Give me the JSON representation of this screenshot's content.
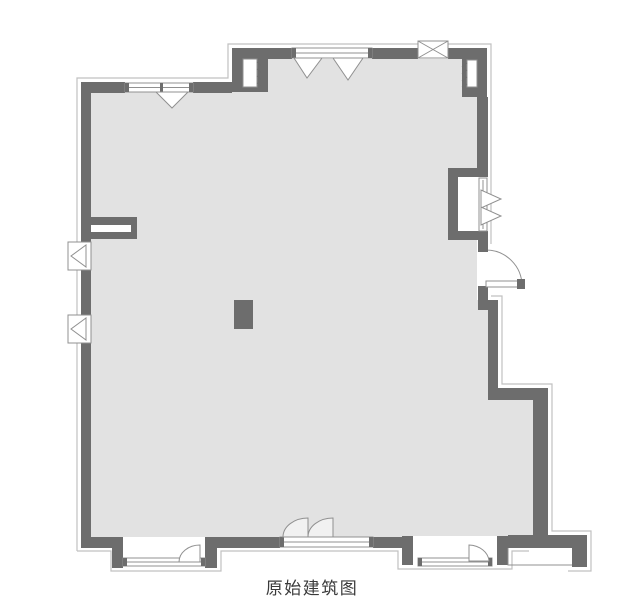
{
  "caption": "原始建筑图",
  "colors": {
    "background": "#ffffff",
    "floor": "#e2e2e2",
    "wall": "#6d6d6d",
    "outline": "#c0c0c0",
    "glass": "#ffffff",
    "sym": "#909090",
    "fin": "#f1f1f1",
    "text": "#3a3a3a"
  },
  "plan": {
    "shapes": [
      {
        "t": "path",
        "n": "outer-outline-left-top",
        "d": "M77,551 L77,78 L228,78 L228,44 L491,44 L491,244",
        "k": "outline",
        "sw": 1.2
      },
      {
        "t": "path",
        "n": "outer-outline-right",
        "d": "M491,296 L502,296 L502,384 L552,384 L552,531 L591,531 L591,571 L568,571",
        "k": "outline",
        "sw": 1.2
      },
      {
        "t": "path",
        "n": "outer-outline-bottom",
        "d": "M77,551 L111,551 L111,571 L221,571 L221,551 L398,551 L398,569 L512,569 L512,551 L529,551",
        "k": "outline",
        "sw": 1.2
      },
      {
        "t": "poly",
        "n": "floor",
        "p": "91,92 268,92 268,59 462,59 462,97 477,97 477,168 448,168 448,240 477,240 477,300 488,300 488,400 533,400 533,537 91,537",
        "f": "floor"
      },
      {
        "t": "rect",
        "n": "bay1-sill",
        "x": 125,
        "y": 537,
        "w": 82,
        "h": 22,
        "f": "glass"
      },
      {
        "t": "rect",
        "n": "bay2-sill",
        "x": 413,
        "y": 536,
        "w": 84,
        "h": 22,
        "f": "glass"
      },
      {
        "t": "rect",
        "n": "wall-left-upper",
        "x": 81,
        "y": 82,
        "w": 10,
        "h": 160,
        "f": "wall"
      },
      {
        "t": "rect",
        "n": "wall-left-mid",
        "x": 81,
        "y": 270,
        "w": 10,
        "h": 45,
        "f": "wall"
      },
      {
        "t": "rect",
        "n": "wall-left-lower",
        "x": 81,
        "y": 343,
        "w": 10,
        "h": 204,
        "f": "wall"
      },
      {
        "t": "rect",
        "n": "wall-top-left-a",
        "x": 81,
        "y": 82,
        "w": 44,
        "h": 11,
        "f": "wall"
      },
      {
        "t": "rect",
        "n": "wall-top-left-b",
        "x": 193,
        "y": 82,
        "w": 39,
        "h": 11,
        "f": "wall"
      },
      {
        "t": "rect",
        "n": "shaft-top-left-body",
        "x": 232,
        "y": 48,
        "w": 36,
        "h": 44,
        "f": "wall"
      },
      {
        "t": "rect",
        "n": "wall-top-upper-a",
        "x": 268,
        "y": 48,
        "w": 24,
        "h": 11,
        "f": "wall"
      },
      {
        "t": "rect",
        "n": "wall-top-upper-b",
        "x": 372,
        "y": 48,
        "w": 46,
        "h": 11,
        "f": "wall"
      },
      {
        "t": "rect",
        "n": "wall-top-upper-c",
        "x": 448,
        "y": 48,
        "w": 39,
        "h": 11,
        "f": "wall"
      },
      {
        "t": "rect",
        "n": "shaft-top-right-body",
        "x": 462,
        "y": 48,
        "w": 25,
        "h": 49,
        "f": "wall"
      },
      {
        "t": "rect",
        "n": "wall-right-upper",
        "x": 477,
        "y": 97,
        "w": 11,
        "h": 71,
        "f": "wall"
      },
      {
        "t": "rect",
        "n": "niche-wall-top",
        "x": 448,
        "y": 168,
        "w": 40,
        "h": 9,
        "f": "wall"
      },
      {
        "t": "rect",
        "n": "niche-wall-left",
        "x": 448,
        "y": 168,
        "w": 10,
        "h": 72,
        "f": "wall"
      },
      {
        "t": "rect",
        "n": "niche-wall-bottom",
        "x": 448,
        "y": 231,
        "w": 40,
        "h": 9,
        "f": "wall"
      },
      {
        "t": "rect",
        "n": "door-jamb-top",
        "x": 478,
        "y": 240,
        "w": 10,
        "h": 12,
        "f": "wall"
      },
      {
        "t": "rect",
        "n": "door-jamb-bottom",
        "x": 478,
        "y": 286,
        "w": 10,
        "h": 24,
        "f": "wall"
      },
      {
        "t": "rect",
        "n": "wall-jog",
        "x": 478,
        "y": 300,
        "w": 20,
        "h": 10,
        "f": "wall"
      },
      {
        "t": "rect",
        "n": "wall-right-mid",
        "x": 488,
        "y": 300,
        "w": 10,
        "h": 100,
        "f": "wall"
      },
      {
        "t": "rect",
        "n": "wall-step-bar",
        "x": 488,
        "y": 388,
        "w": 60,
        "h": 12,
        "f": "wall"
      },
      {
        "t": "rect",
        "n": "wall-right-lower",
        "x": 533,
        "y": 400,
        "w": 15,
        "h": 137,
        "f": "wall"
      },
      {
        "t": "rect",
        "n": "wall-bottom-right",
        "x": 508,
        "y": 535,
        "w": 79,
        "h": 13,
        "f": "wall"
      },
      {
        "t": "rect",
        "n": "porch-stub",
        "x": 572,
        "y": 535,
        "w": 15,
        "h": 32,
        "f": "wall"
      },
      {
        "t": "rect",
        "n": "bay2-stub-left",
        "x": 402,
        "y": 536,
        "w": 11,
        "h": 29,
        "f": "wall"
      },
      {
        "t": "rect",
        "n": "bay2-stub-right",
        "x": 497,
        "y": 536,
        "w": 11,
        "h": 29,
        "f": "wall"
      },
      {
        "t": "rect",
        "n": "wall-bottom-mid-right",
        "x": 373,
        "y": 537,
        "w": 29,
        "h": 11,
        "f": "wall"
      },
      {
        "t": "rect",
        "n": "wall-bottom-mid-left",
        "x": 217,
        "y": 537,
        "w": 63,
        "h": 11,
        "f": "wall"
      },
      {
        "t": "rect",
        "n": "bay1-stub-left",
        "x": 112,
        "y": 537,
        "w": 11,
        "h": 31,
        "f": "wall"
      },
      {
        "t": "rect",
        "n": "bay1-stub-right",
        "x": 205,
        "y": 537,
        "w": 12,
        "h": 31,
        "f": "wall"
      },
      {
        "t": "rect",
        "n": "wall-bottom-left",
        "x": 81,
        "y": 537,
        "w": 34,
        "h": 11,
        "f": "wall"
      },
      {
        "t": "rect",
        "n": "shaft-top-left-inset",
        "x": 243,
        "y": 59,
        "w": 14,
        "h": 28,
        "f": "glass",
        "k": "sym"
      },
      {
        "t": "path",
        "n": "shaft-top-left-hatch",
        "d": "M257,62 l5,4 M257,69 l5,4 M257,76 l5,4 M257,83 l5,3",
        "k": "wall"
      },
      {
        "t": "rect",
        "n": "shaft-top-right-inset",
        "x": 467,
        "y": 60,
        "w": 10,
        "h": 27,
        "f": "glass",
        "k": "sym"
      },
      {
        "t": "path",
        "n": "shaft-top-right-hatch",
        "d": "M467,63 l-5,4 M467,70 l-5,4 M467,77 l-5,4 M467,84 l-5,3",
        "k": "wall"
      },
      {
        "t": "rect",
        "n": "partition-stub-body",
        "x": 91,
        "y": 217,
        "w": 46,
        "h": 22,
        "f": "wall"
      },
      {
        "t": "rect",
        "n": "partition-stub-core",
        "x": 91,
        "y": 225,
        "w": 40,
        "h": 7,
        "f": "glass"
      },
      {
        "t": "rect",
        "n": "window-top-left",
        "x": 125,
        "y": 83,
        "w": 68,
        "h": 9,
        "f": "glass",
        "k": "sym"
      },
      {
        "t": "path",
        "n": "window-top-left-line",
        "d": "M125,87.5 H193",
        "k": "sym"
      },
      {
        "t": "rect",
        "n": "window-top-left-cap-l",
        "x": 125,
        "y": 83,
        "w": 4,
        "h": 9,
        "f": "wall"
      },
      {
        "t": "rect",
        "n": "window-top-left-cap-r",
        "x": 189,
        "y": 83,
        "w": 4,
        "h": 9,
        "f": "wall"
      },
      {
        "t": "rect",
        "n": "window-top-left-post",
        "x": 160,
        "y": 83,
        "w": 3,
        "h": 9,
        "f": "wall"
      },
      {
        "t": "poly",
        "n": "casement-top-left",
        "p": "156,92 188,92 172,108",
        "f": "glass",
        "k": "sym"
      },
      {
        "t": "rect",
        "n": "window-top",
        "x": 292,
        "y": 48,
        "w": 80,
        "h": 10,
        "f": "glass",
        "k": "sym"
      },
      {
        "t": "path",
        "n": "window-top-line",
        "d": "M292,53 H372",
        "k": "sym"
      },
      {
        "t": "rect",
        "n": "window-top-cap-l",
        "x": 292,
        "y": 48,
        "w": 4,
        "h": 10,
        "f": "wall"
      },
      {
        "t": "rect",
        "n": "window-top-cap-r",
        "x": 368,
        "y": 48,
        "w": 4,
        "h": 10,
        "f": "wall"
      },
      {
        "t": "poly",
        "n": "casement-top-1",
        "p": "294,58 322,58 307,78",
        "f": "glass",
        "k": "sym"
      },
      {
        "t": "poly",
        "n": "casement-top-2",
        "p": "333,58 363,58 348,80",
        "f": "glass",
        "k": "sym"
      },
      {
        "t": "rect",
        "n": "flue-box",
        "x": 418,
        "y": 41,
        "w": 30,
        "h": 17,
        "f": "glass",
        "k": "sym"
      },
      {
        "t": "path",
        "n": "flue-box-cross",
        "d": "M418,41 L448,58 M448,41 L418,58",
        "k": "sym"
      },
      {
        "t": "rect",
        "n": "window-left-a",
        "x": 68,
        "y": 242,
        "w": 23,
        "h": 28,
        "f": "glass",
        "k": "sym"
      },
      {
        "t": "poly",
        "n": "casement-left-a",
        "p": "86,245 86,267 71,256",
        "f": "glass",
        "k": "sym"
      },
      {
        "t": "rect",
        "n": "window-left-b",
        "x": 68,
        "y": 315,
        "w": 23,
        "h": 28,
        "f": "glass",
        "k": "sym"
      },
      {
        "t": "poly",
        "n": "casement-left-b",
        "p": "86,318 86,340 71,329",
        "f": "glass",
        "k": "sym"
      },
      {
        "t": "rect",
        "n": "window-niche-right",
        "x": 479,
        "y": 178,
        "w": 8,
        "h": 53,
        "f": "glass",
        "k": "sym"
      },
      {
        "t": "path",
        "n": "window-niche-right-line",
        "d": "M483,180 V229",
        "k": "sym"
      },
      {
        "t": "poly",
        "n": "casement-niche-1",
        "p": "481,190 481,208 501,199",
        "f": "glass",
        "k": "sym"
      },
      {
        "t": "poly",
        "n": "casement-niche-2",
        "p": "481,207 481,225 501,216",
        "f": "glass",
        "k": "sym"
      },
      {
        "t": "path",
        "n": "door-swing-arc",
        "d": "M486,250 A36,36 0 0 1 522,286",
        "k": "sym"
      },
      {
        "t": "rect",
        "n": "door-leaf",
        "x": 486,
        "y": 281,
        "w": 33,
        "h": 6,
        "f": "glass",
        "k": "sym"
      },
      {
        "t": "rect",
        "n": "door-leaf-cap",
        "x": 517,
        "y": 279,
        "w": 8,
        "h": 10,
        "f": "wall"
      },
      {
        "t": "rect",
        "n": "door-hinge",
        "x": 479,
        "y": 246,
        "w": 9,
        "h": 6,
        "f": "wall"
      },
      {
        "t": "rect",
        "n": "bay1-window",
        "x": 123,
        "y": 558,
        "w": 82,
        "h": 8,
        "f": "glass",
        "k": "sym"
      },
      {
        "t": "path",
        "n": "bay1-window-line",
        "d": "M123,562 H205",
        "k": "sym"
      },
      {
        "t": "rect",
        "n": "bay1-cap-l",
        "x": 123,
        "y": 558,
        "w": 4,
        "h": 8,
        "f": "wall"
      },
      {
        "t": "rect",
        "n": "bay1-cap-r",
        "x": 201,
        "y": 558,
        "w": 4,
        "h": 8,
        "f": "wall"
      },
      {
        "t": "path",
        "n": "bay1-casement",
        "d": "M200,545 L200,562 L179,562 A21,17 0 0 1 200,545 Z",
        "f": "glass",
        "k": "sym"
      },
      {
        "t": "rect",
        "n": "window-bottom-strip",
        "x": 280,
        "y": 537,
        "w": 93,
        "h": 10,
        "f": "glass",
        "k": "sym"
      },
      {
        "t": "path",
        "n": "window-bottom-strip-line",
        "d": "M280,542 H373",
        "k": "sym"
      },
      {
        "t": "rect",
        "n": "strip-cap-l",
        "x": 280,
        "y": 537,
        "w": 4,
        "h": 10,
        "f": "wall"
      },
      {
        "t": "rect",
        "n": "strip-cap-r",
        "x": 369,
        "y": 537,
        "w": 4,
        "h": 10,
        "f": "wall"
      },
      {
        "t": "path",
        "n": "swing-fin-1",
        "d": "M283,537 A25,19 0 0 1 308,518 L308,537 Z",
        "f": "fin",
        "k": "sym"
      },
      {
        "t": "path",
        "n": "swing-fin-2",
        "d": "M308,537 A25,19 0 0 1 333,518 L333,537 Z",
        "f": "fin",
        "k": "sym"
      },
      {
        "t": "rect",
        "n": "bay2-window",
        "x": 418,
        "y": 558,
        "w": 74,
        "h": 8,
        "f": "glass",
        "k": "sym"
      },
      {
        "t": "path",
        "n": "bay2-window-line",
        "d": "M418,562 H492",
        "k": "sym"
      },
      {
        "t": "rect",
        "n": "bay2-cap-l",
        "x": 418,
        "y": 558,
        "w": 4,
        "h": 8,
        "f": "wall"
      },
      {
        "t": "rect",
        "n": "bay2-cap-r",
        "x": 488,
        "y": 558,
        "w": 4,
        "h": 8,
        "f": "wall"
      },
      {
        "t": "path",
        "n": "bay2-casement",
        "d": "M469,545 L469,561 L489,561 A21,17 0 0 0 469,545 Z",
        "f": "glass",
        "k": "sym"
      },
      {
        "t": "path",
        "n": "porch-edge",
        "d": "M508,548 L508,565 L572,565",
        "k": "sym"
      },
      {
        "t": "rect",
        "n": "column",
        "x": 234,
        "y": 300,
        "w": 19,
        "h": 29,
        "f": "wall"
      }
    ]
  }
}
